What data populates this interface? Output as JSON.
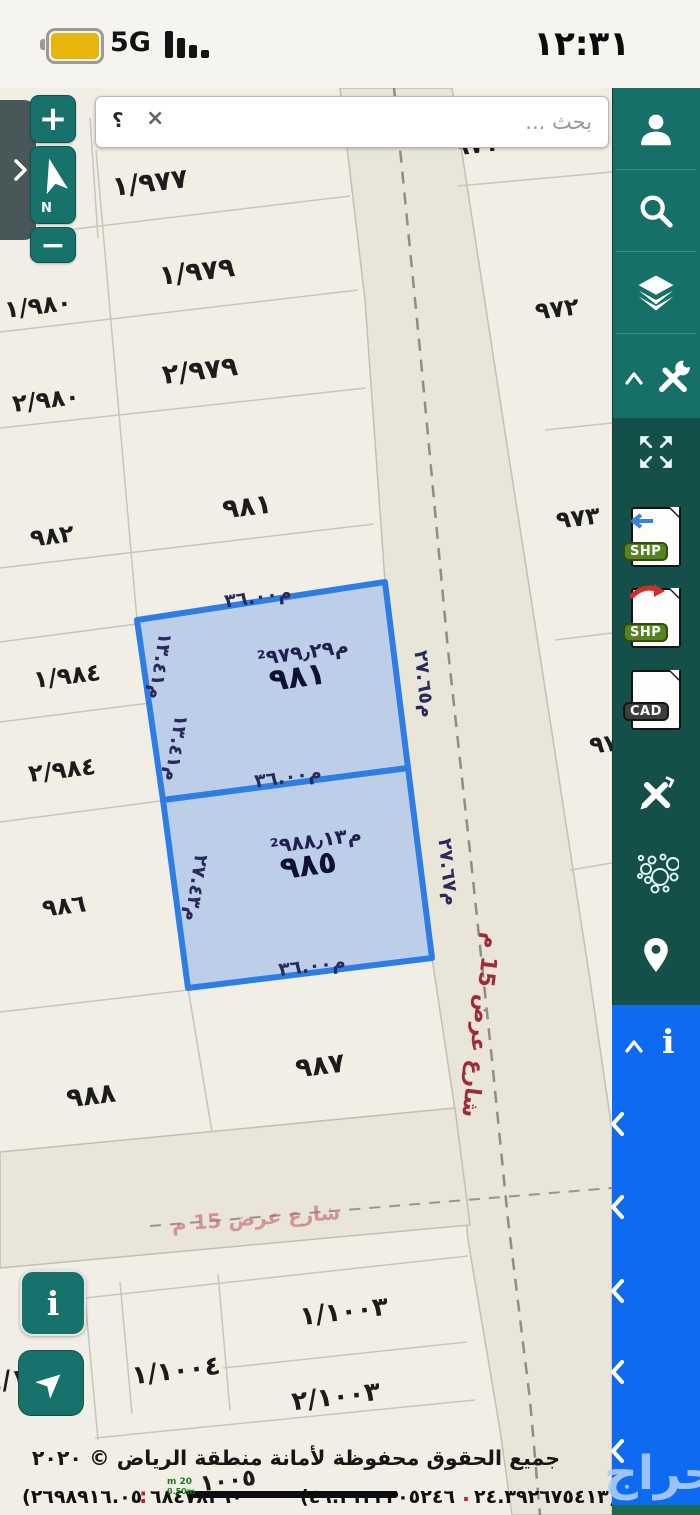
{
  "status_bar": {
    "time": "١٢:٣١",
    "network": "5G"
  },
  "search_bar": {
    "placeholder": "بحث ...",
    "help_label": "؟",
    "clear_label": "×"
  },
  "map_controls": {
    "zoom_in": "+",
    "zoom_out": "−",
    "compass_north": "N",
    "info_label": "i"
  },
  "sidebar": {
    "shp_import_badge": "SHP",
    "shp_export_badge": "SHP",
    "cad_badge": "CAD",
    "info_label": "i"
  },
  "map": {
    "parcels": [
      {
        "label": "١/٩٧٧"
      },
      {
        "label": "٩٧١"
      },
      {
        "label": "١/٩٧٩"
      },
      {
        "label": "٩٧٢"
      },
      {
        "label": "١/٩٨٠"
      },
      {
        "label": "٢/٩٧٩"
      },
      {
        "label": "٢/٩٨٠"
      },
      {
        "label": "٩٨١"
      },
      {
        "label": "٩٨٢"
      },
      {
        "label": "٩٧٣"
      },
      {
        "label": "١/٩٨٤"
      },
      {
        "label": "٩٧"
      },
      {
        "label": "٢/٩٨٤"
      },
      {
        "label": "٩٨٦"
      },
      {
        "label": "٩٨٧"
      },
      {
        "label": "٩٨٨"
      },
      {
        "label": "١/١٠٠٣"
      },
      {
        "label": "١/١٠٠٤"
      },
      {
        "label": "٤/١٠٠٤"
      },
      {
        "label": "٢/١٠٠٣"
      },
      {
        "label": "١٠٠٥"
      }
    ],
    "highlighted_parcels": [
      {
        "number": "٩٨١",
        "area": "²م٩٧٩٫٢٩",
        "edges": {
          "top": "م٣٦.٠٠",
          "left_upper": "م١٣.٤١",
          "left_lower": "م١٣.٤١",
          "right": "م٢٧.٦٥",
          "bottom": "م٣٦.٠٠"
        }
      },
      {
        "number": "٩٨٥",
        "area": "²م٩٨٨٫١٣",
        "edges": {
          "left": "م٢٧.٤٣",
          "right": "م٢٧.٦٧",
          "bottom": "م٣٦.٠٠"
        }
      }
    ],
    "street_label_vertical": "شارع عرض 15 م",
    "street_label_horizontal": "شارع عرض 15 م"
  },
  "footer": {
    "copyright": "جميع الحقوق محفوظة لأمانة منطقة الرياض © ٢٠٢٠",
    "coord_left": "(٢٦٩٨٩١٦.٠٥",
    "coord_left_sep": ":",
    "coord_left_2": "٦٨٤٧٨٢٦٠",
    "coord_right": "(٤٦.٣١٢٢٣٠٥٢٤٦",
    "coord_right_sep": ".",
    "coord_right_2": "٢٤.٣٩٢٦٧٥٤١٣)",
    "scale_top": "m 20",
    "scale_bottom": "0.50m"
  },
  "watermark": "حراج",
  "colors": {
    "sidebar_teal": "#177068",
    "sidebar_dark_teal": "#144f49",
    "sidebar_blue": "#0e6af0",
    "highlight_blue": "#2e7de4",
    "highlight_fill": "#9cbaea",
    "street_red": "#9e2a3a",
    "battery_gold": "#e7b50c",
    "road_fill": "#e9e5d8"
  }
}
